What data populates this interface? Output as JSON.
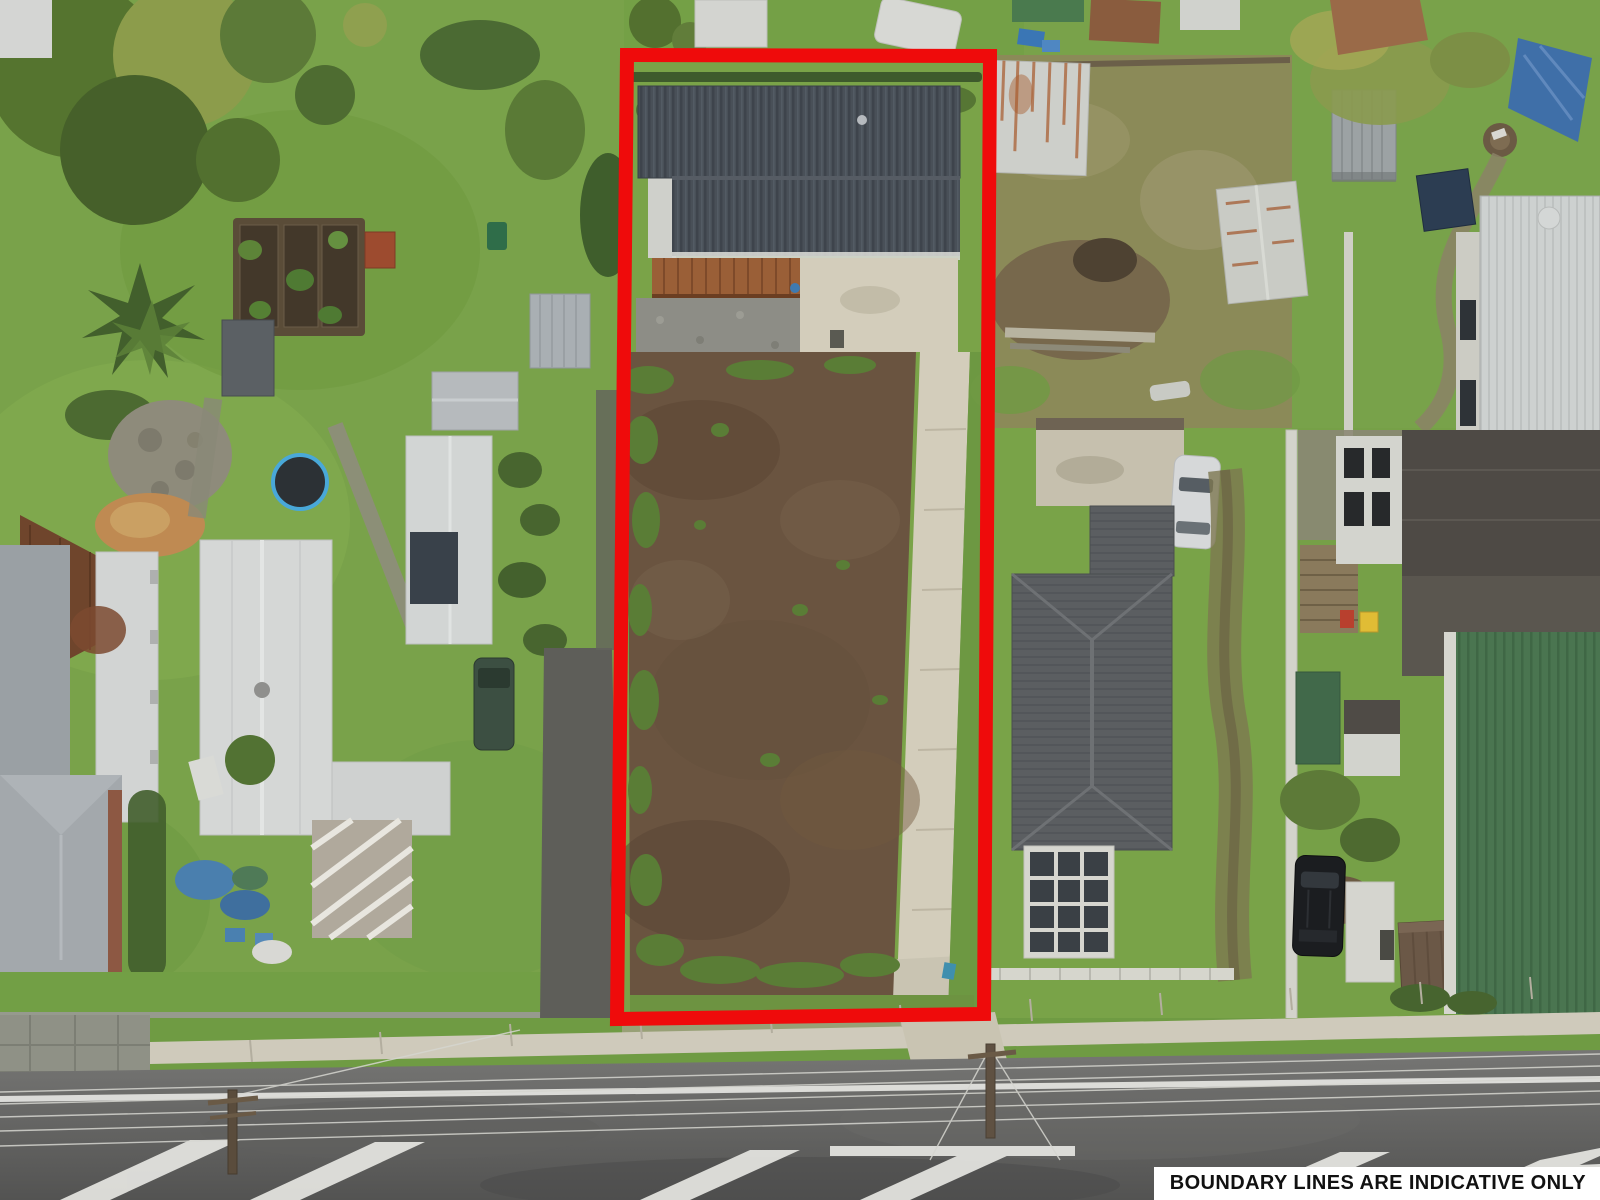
{
  "disclaimer": {
    "text": "BOUNDARY LINES ARE INDICATIVE ONLY"
  },
  "overlay": {
    "boundary_color": "#ef0b0b"
  },
  "palette": {
    "lawn_green": "#79a24a",
    "bare_soil_brown": "#6a5440",
    "concrete_driveway": "#d3cdbb",
    "asphalt_road": "#5f5f5d",
    "subject_house_roof": "#495058"
  }
}
